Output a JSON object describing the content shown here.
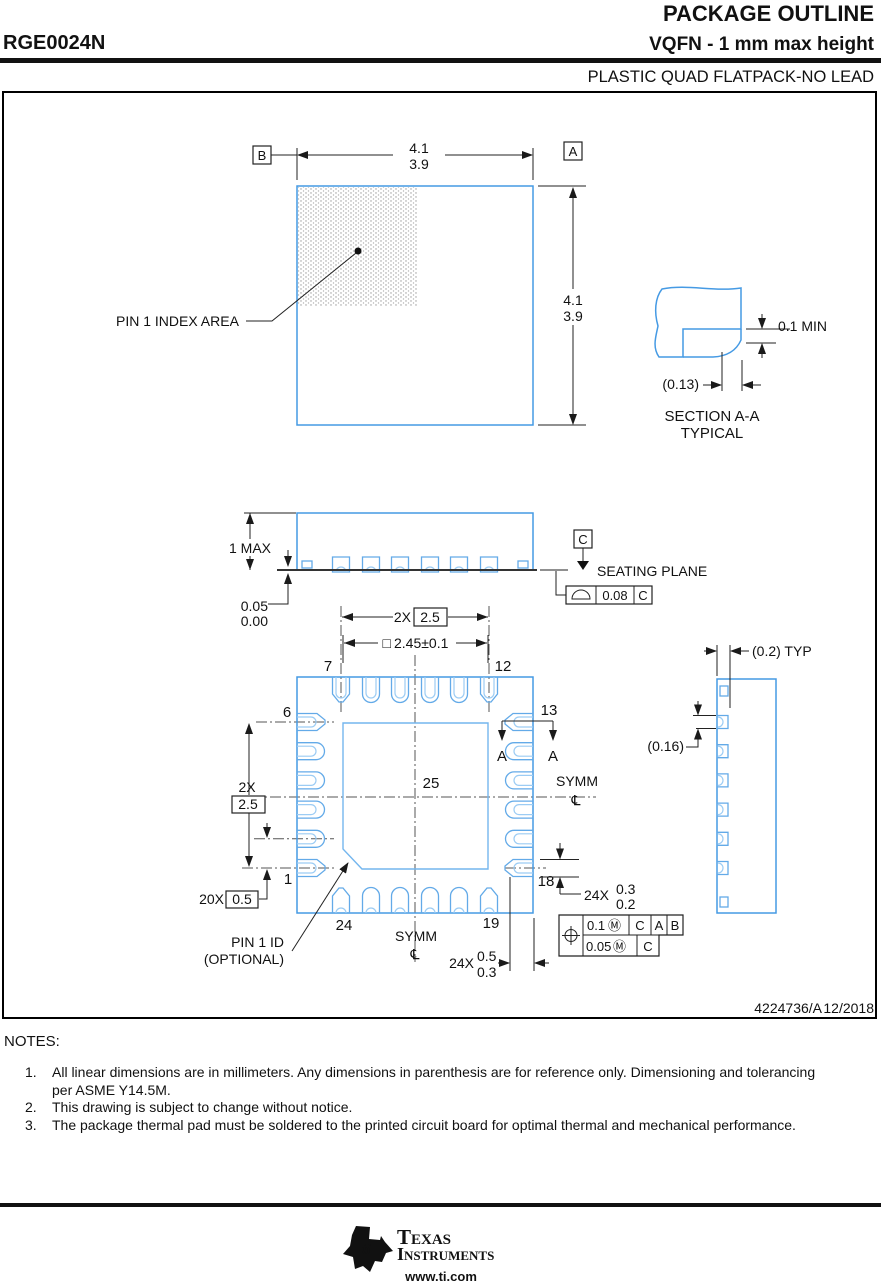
{
  "header": {
    "doc_title": "PACKAGE OUTLINE",
    "part_number": "RGE0024N",
    "variant": "VQFN - 1 mm max height",
    "family": "PLASTIC QUAD FLATPACK-NO LEAD"
  },
  "top_view": {
    "datum_b": "B",
    "datum_a": "A",
    "width_max": "4.1",
    "width_min": "3.9",
    "height_max": "4.1",
    "height_min": "3.9",
    "pin1_index": "PIN 1 INDEX AREA"
  },
  "section_aa": {
    "lead_thickness": "0.1 MIN",
    "wettable_flank": "(0.13)",
    "title": "SECTION A-A",
    "subtitle": "TYPICAL"
  },
  "side_view": {
    "height_max": "1 MAX",
    "standoff_max": "0.05",
    "standoff_min": "0.00",
    "datum_c": "C",
    "seating_plane": "SEATING PLANE",
    "flatness_tol": "0.08",
    "flatness_datum": "C"
  },
  "bottom_view": {
    "row_pitch_qty": "2X",
    "row_pitch": "2.5",
    "thermal_symbol": "□",
    "thermal_size": "2.45±0.1",
    "pins": {
      "p1": "1",
      "p6": "6",
      "p7": "7",
      "p12": "12",
      "p13": "13",
      "p18": "18",
      "p19": "19",
      "p24": "24",
      "thermal_pad": "25"
    },
    "section_mark_left": "A",
    "section_mark_right": "A",
    "symm_right": "SYMM",
    "symm_right_cl": "℄",
    "symm_bottom": "SYMM",
    "symm_bottom_cl": "℄",
    "col_pitch_qty": "2X",
    "col_pitch": "2.5",
    "lead_pitch_qty": "20X",
    "lead_pitch": "0.5",
    "pin1_id_line1": "PIN 1 ID",
    "pin1_id_line2": "(OPTIONAL)",
    "lead_length_qty": "24X",
    "lead_length_max": "0.5",
    "lead_length_min": "0.3",
    "lead_width_qty": "24X",
    "lead_width_max": "0.3",
    "lead_width_min": "0.2",
    "fcf1": {
      "tol": "0.1",
      "modifier": "Ⓜ",
      "datum1": "C",
      "datum2": "A",
      "datum3": "B"
    },
    "fcf2": {
      "tol": "0.05",
      "modifier": "Ⓜ",
      "datum1": "C"
    }
  },
  "detail_view": {
    "pad_offset": "(0.2) TYP",
    "pad_gap": "(0.16)"
  },
  "title_block": {
    "drawing_id": "4224736/A",
    "revision_date": "12/2018"
  },
  "notes": {
    "heading": "NOTES:",
    "items": [
      {
        "num": "1.",
        "lines": [
          "All linear dimensions are in millimeters. Any dimensions in parenthesis are for reference only. Dimensioning and tolerancing",
          "per ASME Y14.5M."
        ]
      },
      {
        "num": "2.",
        "lines": [
          "This drawing is subject to change without notice."
        ]
      },
      {
        "num": "3.",
        "lines": [
          "The package thermal pad must be soldered to the printed circuit board for optimal thermal and mechanical performance."
        ]
      }
    ]
  },
  "footer": {
    "brand_line1": "Texas",
    "brand_line2": "Instruments",
    "logo_monogram": "ti",
    "website": "www.ti.com"
  },
  "colors": {
    "outline_blue": "#459ae4",
    "pad_blue": "#63aae8",
    "pad_inner_blue": "#9cccf4",
    "thermal_blue": "#74b6ee",
    "line_black": "#1a1a1a"
  }
}
